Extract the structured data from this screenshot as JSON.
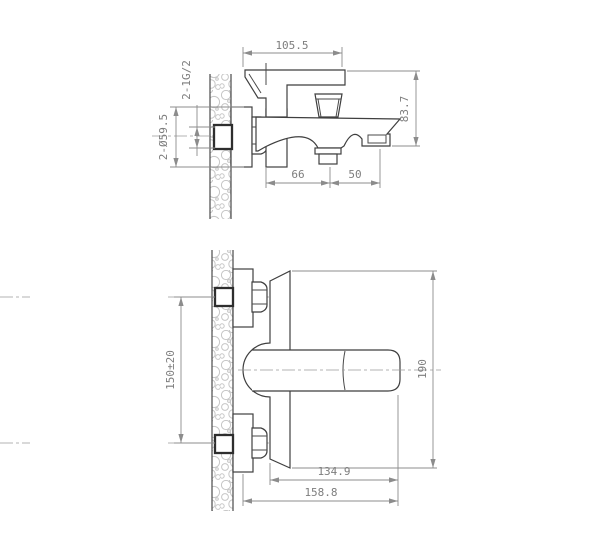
{
  "drawing_title": "wall-mounted bath mixer installation dimension drawing",
  "colors": {
    "background": "#ffffff",
    "outline": "#3f3f3f",
    "dimension_lines": "#8c8c8c",
    "dimension_text": "#7d7d7d",
    "wall_hatch": "#c6c6c6"
  },
  "side_view": {
    "dimensions": {
      "handle_width": "105.5",
      "body_height": "83.7",
      "spout_offset": "66",
      "outlet_offset": "50",
      "thread_spec": "2-1G/2",
      "escutcheon_diameter": "2-Ø59.5"
    }
  },
  "plan_view": {
    "dimensions": {
      "inlet_spacing": "150±20",
      "overall_height": "190",
      "handle_reach": "134.9",
      "overall_depth": "158.8"
    }
  }
}
